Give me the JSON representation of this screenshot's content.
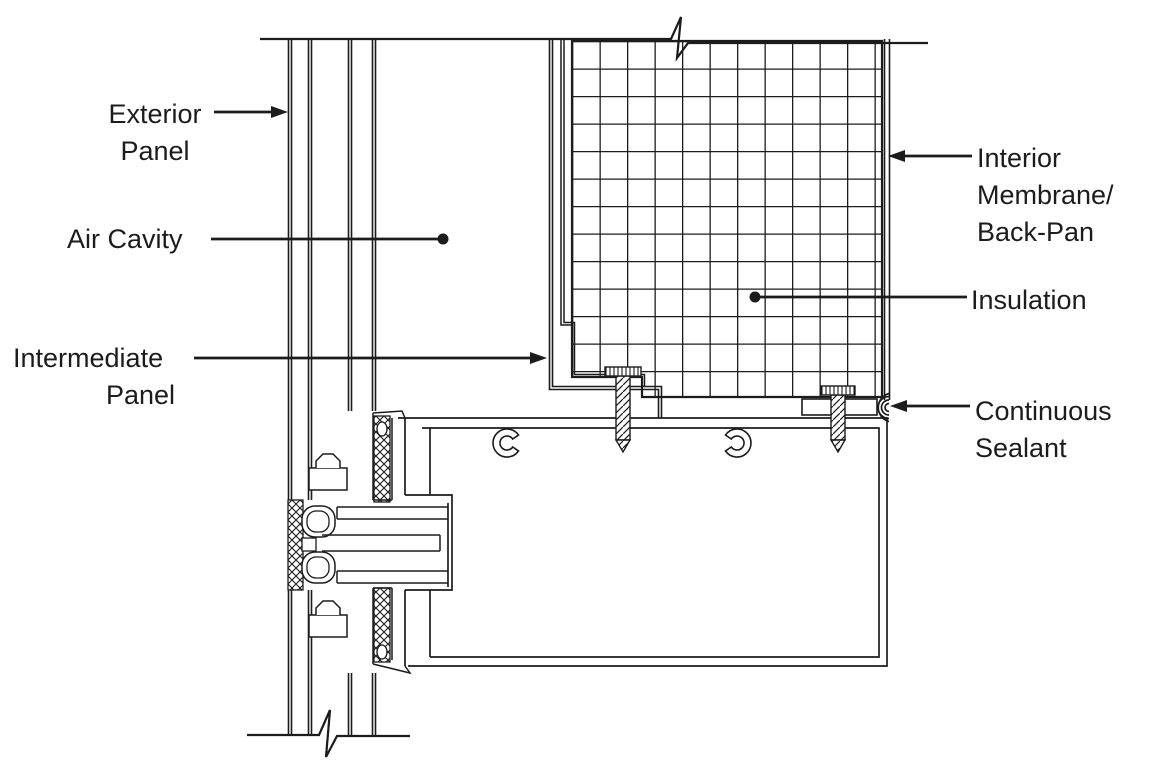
{
  "colors": {
    "ink": "#1c1c1c",
    "background": "#ffffff"
  },
  "labels": {
    "exterior_panel": {
      "lines": [
        "Exterior",
        "Panel"
      ],
      "marker": "arrow-right"
    },
    "air_cavity": {
      "lines": [
        "Air Cavity"
      ],
      "marker": "dot"
    },
    "intermediate_panel": {
      "lines": [
        "Intermediate",
        "Panel"
      ],
      "marker": "arrow-right"
    },
    "interior_membrane": {
      "lines": [
        "Interior",
        "Membrane/",
        "Back-Pan"
      ],
      "marker": "arrow-left"
    },
    "insulation": {
      "lines": [
        "Insulation"
      ],
      "marker": "dot"
    },
    "continuous_sealant": {
      "lines": [
        "Continuous",
        "Sealant"
      ],
      "marker": "arrow-left"
    }
  }
}
